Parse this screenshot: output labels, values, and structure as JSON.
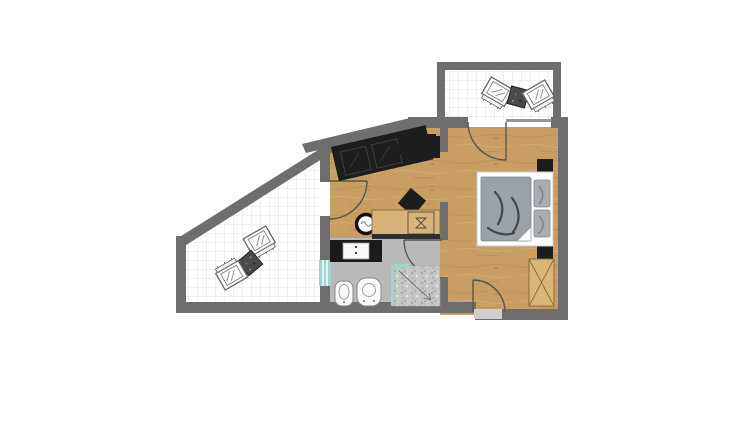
{
  "image": {
    "kind": "floor-plan",
    "width": 754,
    "height": 435,
    "background": "#ffffff"
  },
  "colors": {
    "wall": "#6e6e6e",
    "wood_floor_base": "#c89e63",
    "counter_wood": "#d7b27a",
    "terrace_tile_line": "#e2e2e2",
    "bath_floor": "#b9b9b9",
    "dark_furniture": "#1d1d1d",
    "bed_frame": "#ffffff",
    "bed_duvet": "#9aa1a7",
    "pillow": "#a7adb3",
    "duvet_crease": "#42474d",
    "wardrobe_wood": "#d9b678",
    "wardrobe_line": "#8a6a3c",
    "glass_teal": "#9fd4cf",
    "shower_floor": "#c5c5c5",
    "door_arc": "#555555",
    "fixture_white": "#fafafa",
    "counter_edge": "#303030",
    "window_sill": "#cfcfcf"
  },
  "rooms": {
    "upper_terrace": "terrace-upper",
    "lower_terrace": "terrace-lower",
    "living_area": "living-area",
    "bedroom": "bedroom",
    "bathroom": "bathroom",
    "entry": "entry"
  },
  "furniture": {
    "upper_terrace": [
      "lounge-chair",
      "side-table",
      "lounge-chair"
    ],
    "lower_terrace": [
      "lounge-chair",
      "side-table",
      "lounge-chair"
    ],
    "living_area": [
      "corner-sofa",
      "tv-sideboard",
      "square-coffee-table",
      "round-table",
      "kitchenette-counter",
      "counter-sink"
    ],
    "bedroom": [
      "double-bed",
      "duvet",
      "pillow",
      "pillow",
      "nightstand",
      "nightstand",
      "wardrobe"
    ],
    "bathroom": [
      "vanity-counter",
      "washbasin",
      "bidet",
      "toilet",
      "shower",
      "window"
    ]
  },
  "doors": {
    "living_to_lower_terrace": "swing-door",
    "bedroom_to_upper_terrace": "swing-door",
    "bedroom_to_bathroom": "swing-door",
    "entry_door": "swing-door"
  }
}
